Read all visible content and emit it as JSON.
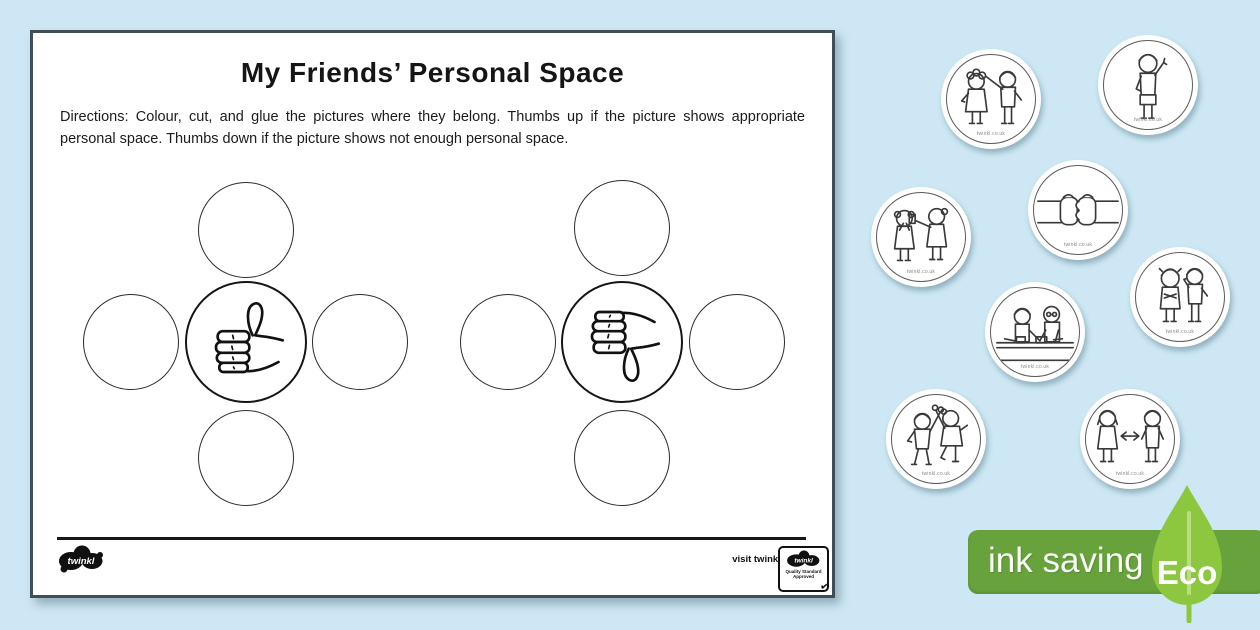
{
  "colors": {
    "background": "#cde8f4",
    "page_border": "#3e4f58",
    "eco_bar_green": "#68a23c",
    "eco_leaf_green": "#8dc63f",
    "ink_black": "#181818"
  },
  "worksheet": {
    "title": "My Friends’ Personal Space",
    "directions": "Directions: Colour, cut, and glue the pictures where they belong. Thumbs up if the picture shows appropriate personal space. Thumbs down if the picture shows not enough personal space.",
    "footer": {
      "logo_text": "twinkl",
      "visit_text": "visit twinkl.com",
      "badge_logo_text": "twinkl",
      "badge_line1": "Quality Standard",
      "badge_line2": "Approved",
      "badge_check": "✔"
    }
  },
  "cards": [
    {
      "scene": "friend-touching-hair",
      "caption": "twinkl.co.uk"
    },
    {
      "scene": "boy-waving",
      "caption": "twinkl.co.uk"
    },
    {
      "scene": "fist-bump",
      "caption": "twinkl.co.uk"
    },
    {
      "scene": "showing-object-too-close",
      "caption": "twinkl.co.uk"
    },
    {
      "scene": "working-together-at-table",
      "caption": "twinkl.co.uk"
    },
    {
      "scene": "talking-too-close",
      "caption": "twinkl.co.uk"
    },
    {
      "scene": "high-five",
      "caption": "twinkl.co.uk"
    },
    {
      "scene": "standing-arms-length-apart",
      "caption": "twinkl.co.uk"
    }
  ],
  "eco_badge": {
    "label": "ink saving",
    "eco": "Eco"
  }
}
